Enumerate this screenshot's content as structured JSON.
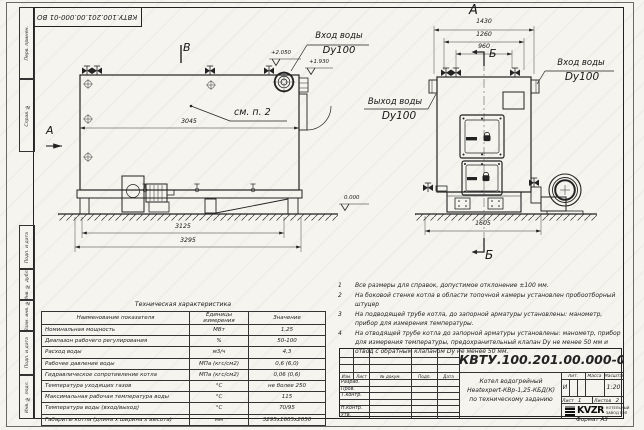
{
  "doc": {
    "number": "КВТУ.100.201.00.000-01 ВО",
    "format": "Формат  А3"
  },
  "frame_labels": {
    "items": [
      "Перв. примен.",
      "Справ. №",
      "Подп. и дата",
      "Инв. № дубл.",
      "Взам. инв. №",
      "Подп. и дата",
      "Инв. № подл."
    ]
  },
  "views": {
    "side": {
      "label_b": "В",
      "label_a": "А",
      "see_note": "см. п. 2",
      "dim_inner": "3045",
      "dim_mid": "3125",
      "dim_outer": "3295",
      "elev_1": "+2.050",
      "elev_2": "+1.930",
      "elev_zero": "0.000",
      "inlet_line1": "Вход воды",
      "inlet_line2": "Dy100"
    },
    "front": {
      "label": "А",
      "section_top": "Б",
      "section_bottom": "Б",
      "dim_1": "1430",
      "dim_2": "1260",
      "dim_3": "960",
      "dim_bottom": "1605",
      "inlet_line1": "Вход воды",
      "inlet_line2": "Dy100",
      "outlet_line1": "Выход воды",
      "outlet_line2": "Dy100"
    }
  },
  "notes": {
    "items": [
      {
        "num": "1",
        "text": "Все размеры для справок, допустимое отклонение ±100 мм."
      },
      {
        "num": "2",
        "text": "На боковой стенке котла в области топочной камеры установлен пробоотборный штуцер"
      },
      {
        "num": "3",
        "text": "На подводящей трубе котла, до запорной арматуры установлены: манометр, прибор для измерения температуры."
      },
      {
        "num": "4",
        "text": "На отводящей трубе котла до запорной арматуры установлены: манометр, прибор для измерения температуры, предохранительный клапан Dу не менее 50 мм и отвод с обратным клапаном Dу не менее 50 мм."
      }
    ]
  },
  "tech_table": {
    "title": "Техническая характеристика",
    "headers": {
      "name": "Наименование показателя",
      "units": "Единицы измерения",
      "value": "Значение"
    },
    "rows": [
      {
        "name": "Номинальная мощность",
        "units": "МВт",
        "value": "1,25"
      },
      {
        "name": "Диапазон рабочего регулирования",
        "units": "%",
        "value": "50-100"
      },
      {
        "name": "Расход воды",
        "units": "м3/ч",
        "value": "4,3"
      },
      {
        "name": "Рабочее давление воды",
        "units": "МПа (кгс/см2)",
        "value": "0,6 (6,0)"
      },
      {
        "name": "Гидравлическое сопротивление котла",
        "units": "МПа (кгс/см2)",
        "value": "0,06 (0,6)"
      },
      {
        "name": "Температура уходящих газов",
        "units": "°С",
        "value": "не более 250"
      },
      {
        "name": "Максимальная рабочая температура воды",
        "units": "°С",
        "value": "115"
      },
      {
        "name": "Температура воды (вход/выход)",
        "units": "°С",
        "value": "70/95"
      },
      {
        "name": "Габариты котла (длина х ширина х высота)",
        "units": "мм",
        "value": "3295х1605х2050"
      }
    ]
  },
  "title_block": {
    "number": "КВТУ.100.201.00.000-01 ВО",
    "name_line1": "Котел водогрейный",
    "name_line2": "Heatexpert-КВр-1,25-КБД(К)",
    "name_line3": "по техническому заданию",
    "rev_headers": [
      "Изм.",
      "Лист",
      "№ докум.",
      "Подп.",
      "Дата"
    ],
    "roles": [
      "Разраб.",
      "Пров.",
      "Т.контр.",
      "",
      "Н.контр.",
      "Утв."
    ],
    "lit_label": "Лит.",
    "mass_label": "Масса",
    "scale_label": "Масштаб",
    "lit_value": "И",
    "scale_value": "1:20",
    "sheet_label": "Лист",
    "sheet_value": "1",
    "sheets_label": "Листов",
    "sheets_value": "2",
    "company_logo": "KVZR",
    "company_line1": "КОТЕЛЬНЫЙ",
    "company_line2": "ЗАВОД РЭП"
  }
}
